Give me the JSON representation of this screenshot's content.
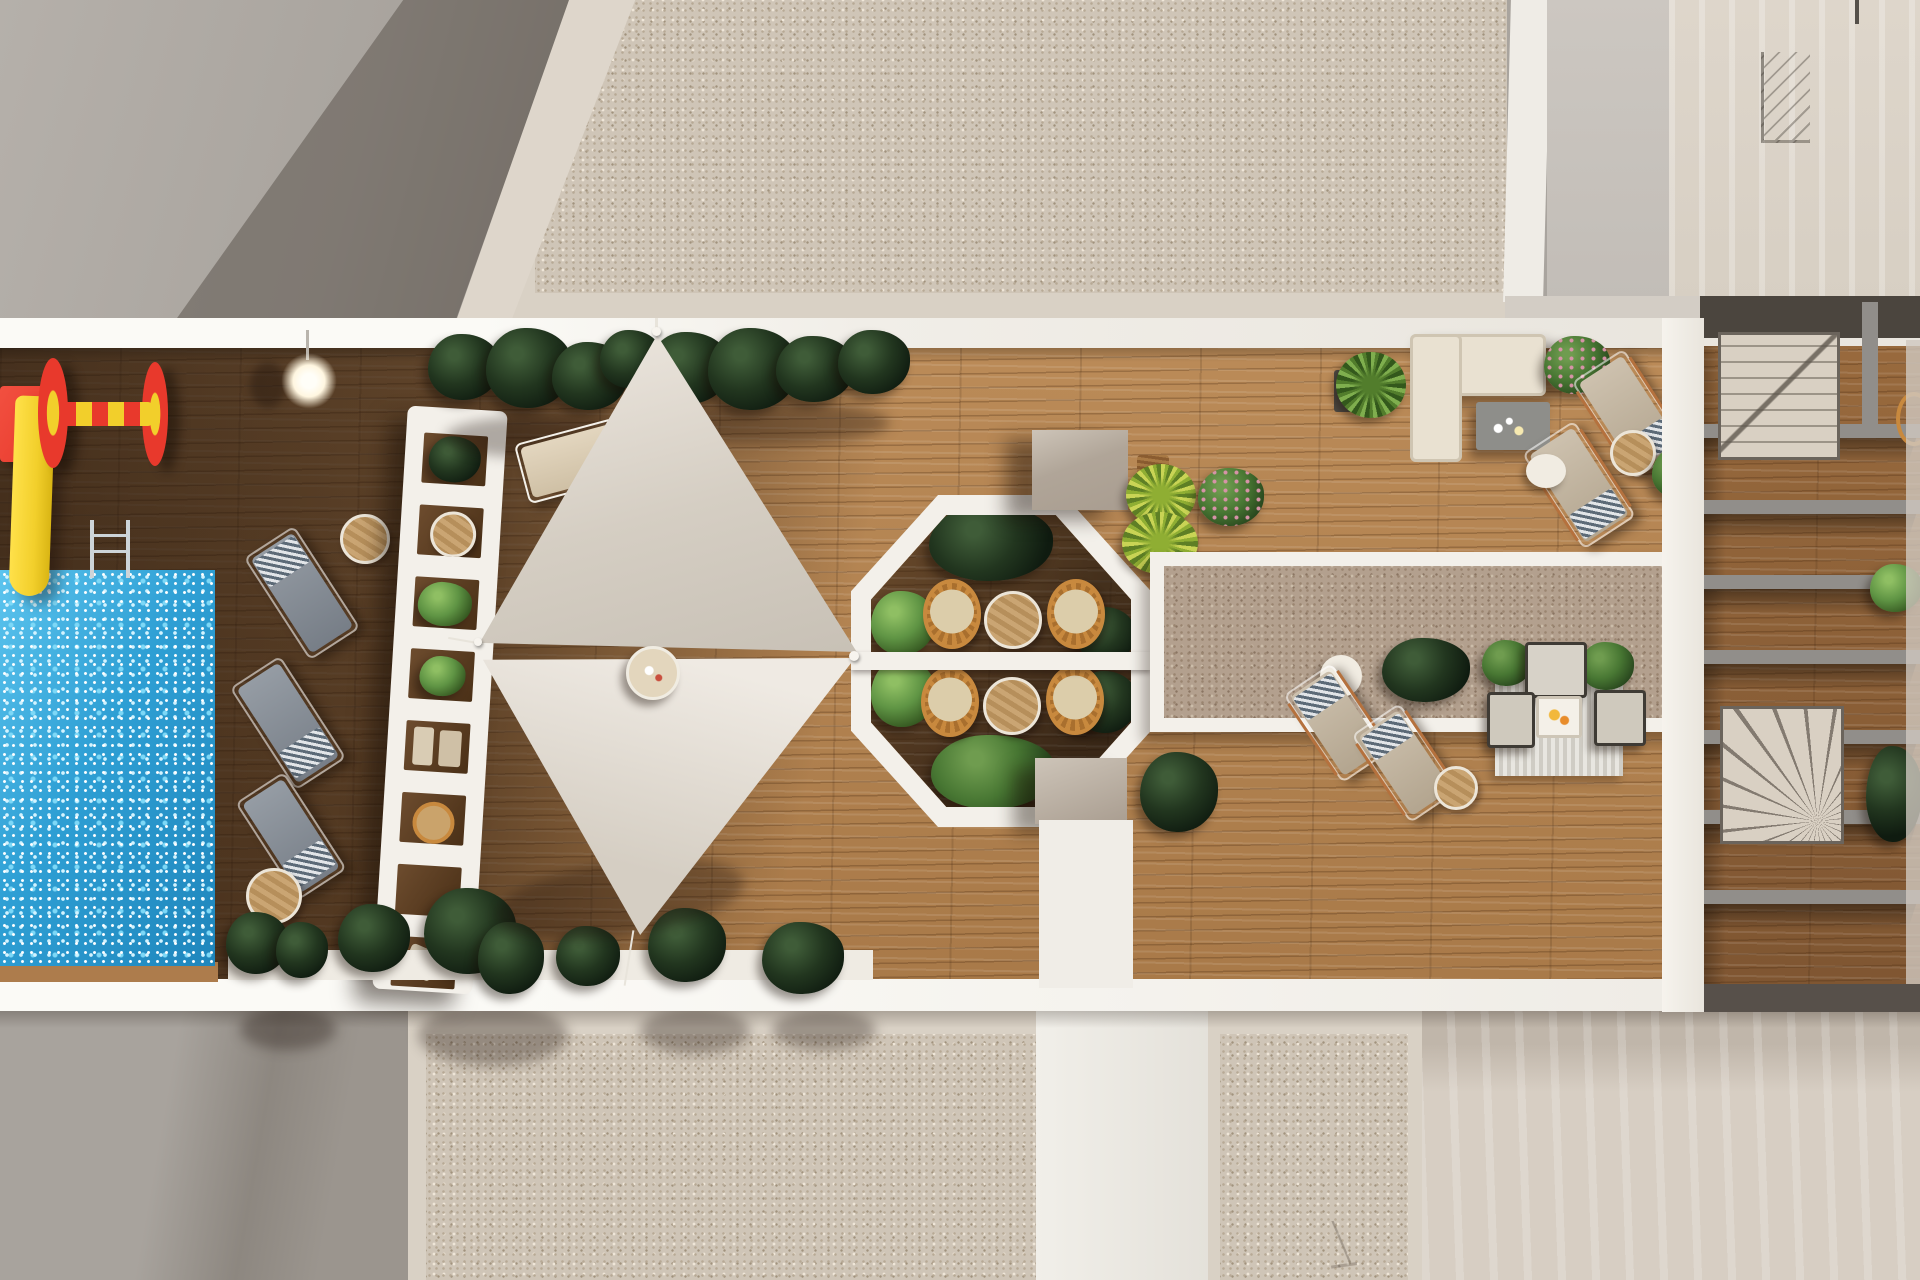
{
  "palette": {
    "white": "#f3f0ea",
    "whiteBright": "#fbfaf6",
    "fasciaShade": "#d3cdc5",
    "graySlab": "#a9a49e",
    "graySlabDark": "#8b857e",
    "graySlabLight": "#b5b0aa",
    "cream": "#d9d1c5",
    "creamSlab": "#ded6cb",
    "creamDark": "#c4bcb0",
    "stipBase": "#cfc5b7",
    "stipD1": "#b7a995",
    "stipD2": "#efe6d8",
    "stipD3": "#a1927d",
    "carpetBase": "#b3a08e",
    "carpetD1": "#9a8570",
    "carpetD2": "#cbbda9",
    "carpetD3": "#8a7562",
    "woodA": "#bb8b58",
    "woodB": "#a87948",
    "woodDarkA": "#7c5733",
    "woodDarkB": "#5f4126",
    "zoneWoodA": "#9a6b3e",
    "zoneWoodB": "#7e5531",
    "poolA": "#5cc4ee",
    "poolB": "#2e9fd4",
    "poolC": "#1f86bc",
    "sparkle1": "#ffffff",
    "sparkle2": "#d2f3ff",
    "sparkle3": "#7dd8f7",
    "sailA": "#ebe5dd",
    "sailB": "#d5cec3",
    "sailC": "#c7c0b5",
    "bushDarkHi": "#3f5c38",
    "bushDarkMid": "#22361f",
    "bushDarkLo": "#0f1b10",
    "bushBrightHi": "#8fbf63",
    "bushBrightMid": "#5f9444",
    "bushBrightLo": "#33551f",
    "bushMidHi": "#6f9c4f",
    "bushMidMid": "#487733",
    "bushMidLo": "#26431c",
    "palmA": "#c9d455",
    "palmB": "#8fae33",
    "palmC": "#5e7f25",
    "pink": "#d793a8",
    "rattan": "#c8893e",
    "rattanDark": "#a96f2e",
    "seatCream": "#dccdaa",
    "tableWoodA": "#caa573",
    "tableWoodB": "#b68f5b",
    "tableRim": "#ece5d8",
    "lngGrayA": "#959ca4",
    "lngGrayB": "#777e87",
    "towelA": "#e2e5e8",
    "towelB": "#5c6a77",
    "lngTanA": "#cdc1ae",
    "lngTanB": "#b3a58f",
    "copper": "#b5713d",
    "sofaCream": "#e9e1d1",
    "tableGray": "#8e8e8a",
    "cubeA": "#cdc4b8",
    "cubeB": "#a99d90",
    "beam": "#918e8a",
    "zoneDark": "#4b453e",
    "stairBeige": "#d9d0c3",
    "stairLine": "#5f584e",
    "lamp": "#fff6e0",
    "red": "#e8392c",
    "yellow": "#f2cf2b",
    "silver": "#cdd4d8",
    "rugA": "#e8e6e0",
    "rugB": "#cfccc4",
    "frameDark": "#3f3b35"
  },
  "scene": {
    "view": "top-down aerial render",
    "setting": "rooftop amenity terrace between building roof slabs",
    "areas": [
      "children-playground",
      "swimming-pool",
      "poolside-loungers",
      "trellis-pergola",
      "shade-sail-lounge",
      "octagonal-dining-pavilion",
      "roof-carpet",
      "corner-sofa-lounge",
      "double-lounger-decks",
      "private-terraces-with-beams",
      "gravel-roof-slabs"
    ],
    "objects": {
      "swimming_pool": 1,
      "water_slide": 1,
      "play_spinner": 1,
      "pool_ladder": 1,
      "lamp": 1,
      "gray_pool_loungers": 3,
      "white_sun_lounger": 1,
      "tan_loungers_upper": 2,
      "tan_loungers_lower": 2,
      "shade_sails": 2,
      "sail_side_table": 1,
      "dining_chairs_rattan": 4,
      "dining_tables_round": 2,
      "dining_divider": 1,
      "corner_sofa": 1,
      "coffee_table_gray": 1,
      "lounge_sofa_set_seats": 3,
      "striped_rug": 1,
      "roof_carpet": 1,
      "concrete_cubes": 2,
      "stair_pergolas": 2,
      "pergola_beams": 7,
      "planter_bushes": "many",
      "yellow_palms": 2,
      "pink_flower_bushes": 2
    }
  }
}
